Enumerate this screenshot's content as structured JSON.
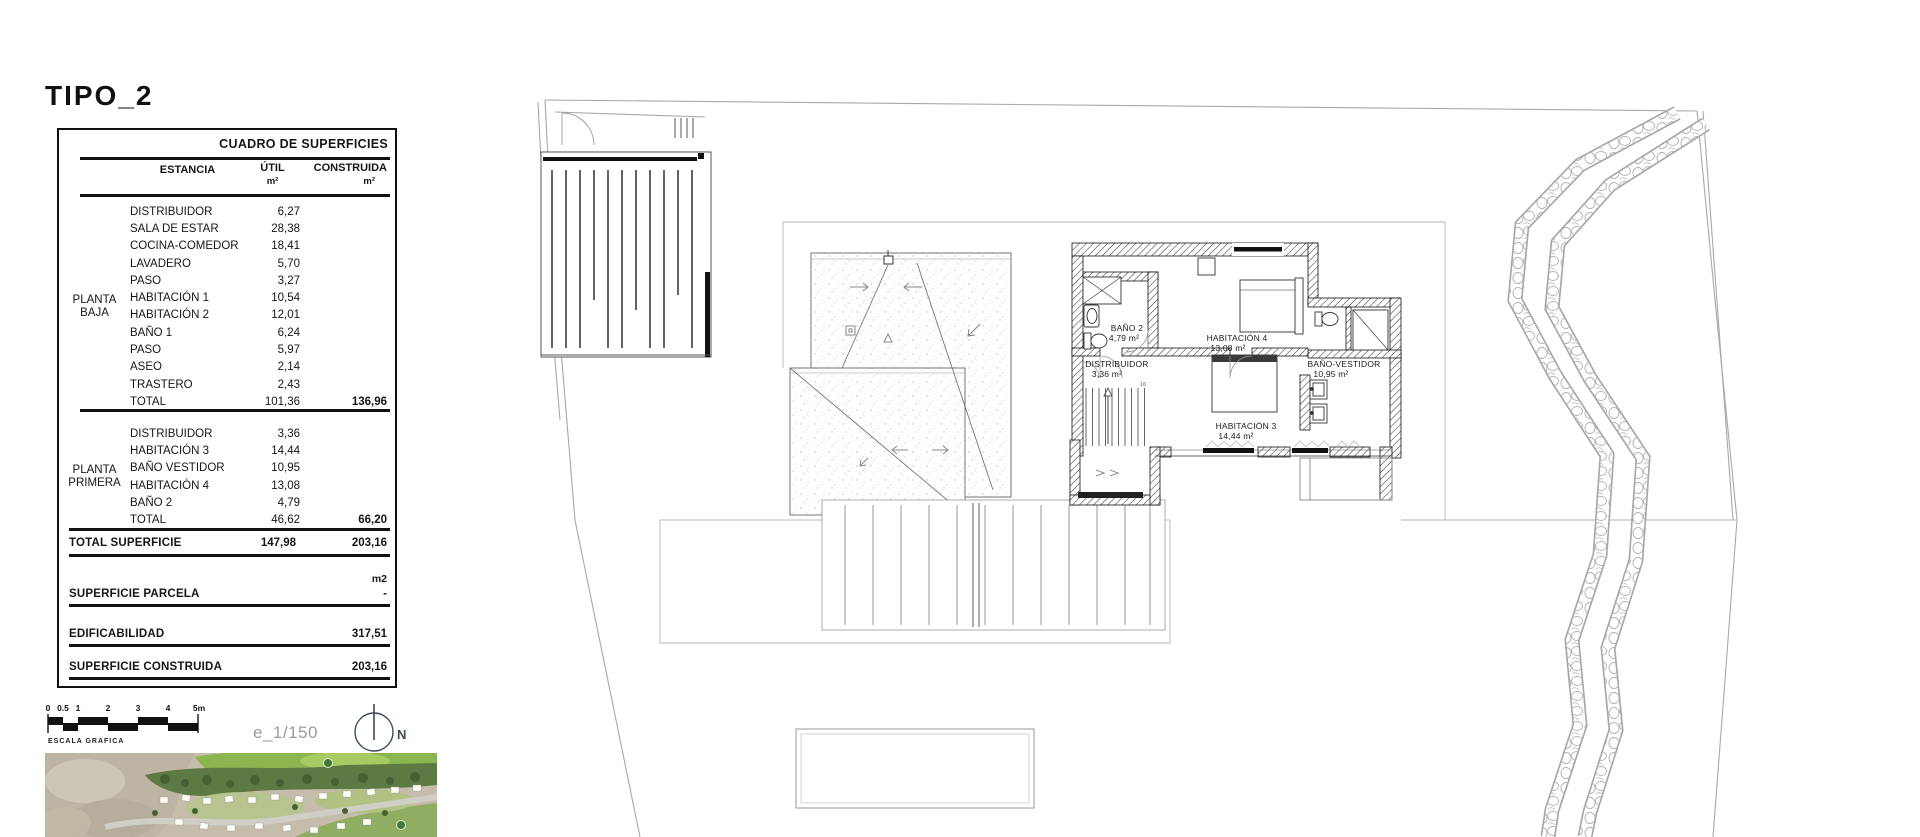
{
  "title": "TIPO_2",
  "table": {
    "header": "CUADRO DE SUPERFICIES",
    "columns": {
      "estancia": "ESTANCIA",
      "util": "ÚTIL",
      "construida": "CONSTRUIDA",
      "unit": "m²"
    },
    "planta_baja": {
      "name_line1": "PLANTA",
      "name_line2": "BAJA",
      "rows": [
        {
          "estancia": "DISTRIBUIDOR",
          "util": "6,27",
          "construida": ""
        },
        {
          "estancia": "SALA DE ESTAR",
          "util": "28,38",
          "construida": ""
        },
        {
          "estancia": "COCINA-COMEDOR",
          "util": "18,41",
          "construida": ""
        },
        {
          "estancia": "LAVADERO",
          "util": "5,70",
          "construida": ""
        },
        {
          "estancia": "PASO",
          "util": "3,27",
          "construida": ""
        },
        {
          "estancia": "HABITACIÓN 1",
          "util": "10,54",
          "construida": ""
        },
        {
          "estancia": "HABITACIÓN 2",
          "util": "12,01",
          "construida": ""
        },
        {
          "estancia": "BAÑO 1",
          "util": "6,24",
          "construida": ""
        },
        {
          "estancia": "PASO",
          "util": "5,97",
          "construida": ""
        },
        {
          "estancia": "ASEO",
          "util": "2,14",
          "construida": ""
        },
        {
          "estancia": "TRASTERO",
          "util": "2,43",
          "construida": ""
        },
        {
          "estancia": "TOTAL",
          "util": "101,36",
          "construida": "136,96"
        }
      ]
    },
    "planta_primera": {
      "name_line1": "PLANTA",
      "name_line2": "PRIMERA",
      "rows": [
        {
          "estancia": "DISTRIBUIDOR",
          "util": "3,36",
          "construida": ""
        },
        {
          "estancia": "HABITACIÓN 3",
          "util": "14,44",
          "construida": ""
        },
        {
          "estancia": "BAÑO VESTIDOR",
          "util": "10,95",
          "construida": ""
        },
        {
          "estancia": "HABITACIÓN 4",
          "util": "13,08",
          "construida": ""
        },
        {
          "estancia": "BAÑO 2",
          "util": "4,79",
          "construida": ""
        },
        {
          "estancia": "TOTAL",
          "util": "46,62",
          "construida": "66,20"
        }
      ]
    },
    "summary": {
      "total_superficie": {
        "label": "TOTAL SUPERFICIE",
        "util": "147,98",
        "construida": "203,16"
      },
      "unit_label": "m2",
      "superficie_parcela": {
        "label": "SUPERFICIE PARCELA",
        "value": "-"
      },
      "edificabilidad": {
        "label": "EDIFICABILIDAD",
        "value": "317,51"
      },
      "superficie_construida": {
        "label": "SUPERFICIE CONSTRUIDA",
        "value": "203,16"
      }
    }
  },
  "scalebar": {
    "ticks": [
      "0",
      "0.5",
      "1",
      "2",
      "3",
      "4",
      "5m"
    ],
    "label": "ESCALA GRAFICA",
    "scale_text": "e_1/150",
    "compass": "N"
  },
  "plan": {
    "stair_label": "16",
    "rooms": [
      {
        "name": "BAÑO 2",
        "area": "4,79 m²"
      },
      {
        "name": "HABITACIÓN 4",
        "area": "13,08 m²"
      },
      {
        "name": "DISTRIBUIDOR",
        "area": "3,36 m²"
      },
      {
        "name": "BAÑO-VESTIDOR",
        "area": "10,95 m²"
      },
      {
        "name": "HABITACIÓN 3",
        "area": "14,44 m²"
      }
    ]
  },
  "colors": {
    "line": "#161616",
    "thin_line": "#a8a8a8",
    "compass": "#3d4a5c"
  }
}
